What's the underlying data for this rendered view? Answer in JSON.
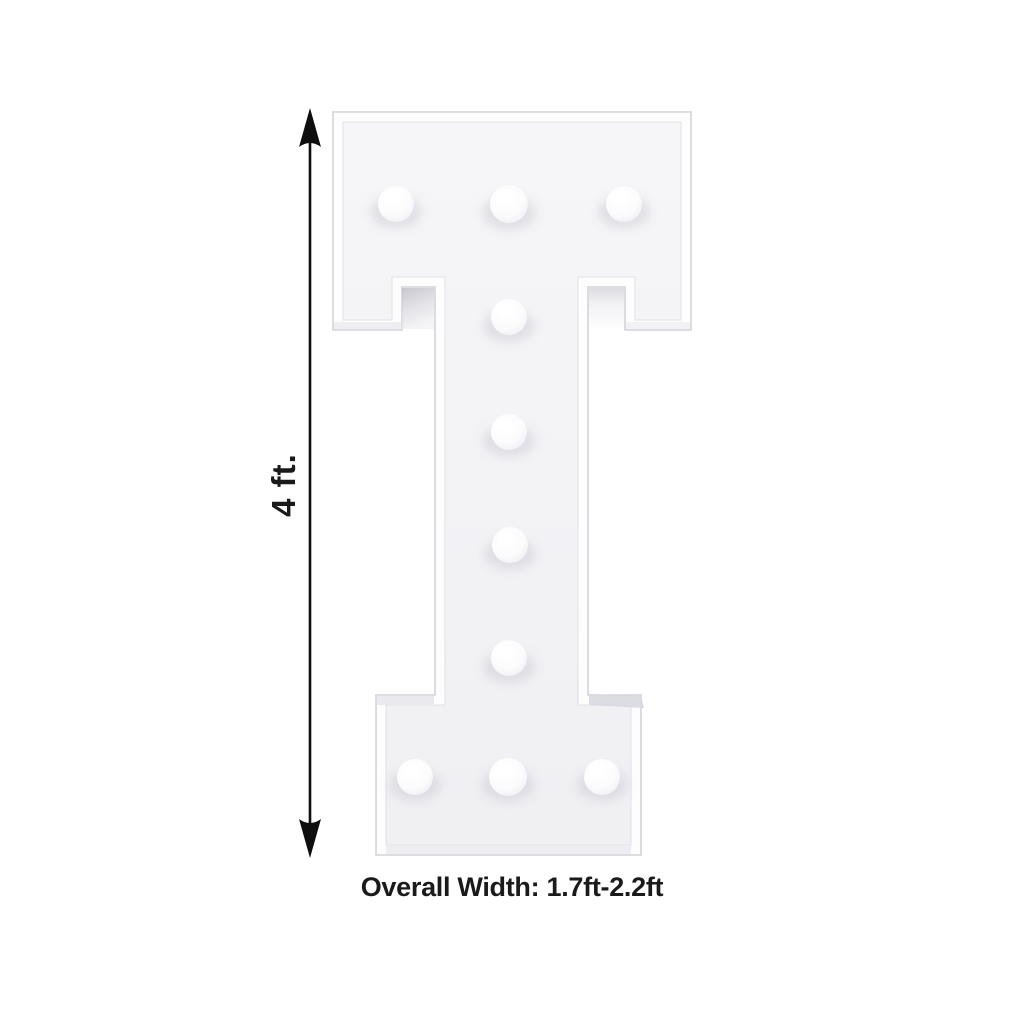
{
  "page": {
    "background_color": "#ffffff"
  },
  "product": {
    "letter": "I",
    "bulb_count": 10,
    "rim_color": "#fdfdfe",
    "panel_color": "#f4f4f6",
    "bulb_color": "#ffffff",
    "edge_color": "#d3d3d9"
  },
  "dimensions": {
    "height_label": "4 ft.",
    "width_label": "Overall Width: 1.7ft-2.2ft",
    "annotation_color": "#141414"
  }
}
